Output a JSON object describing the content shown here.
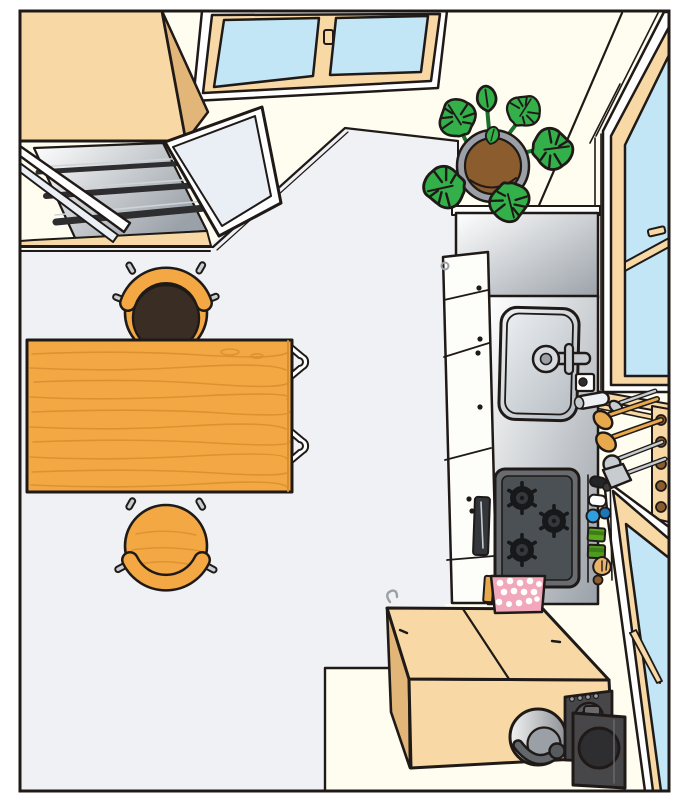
{
  "meta": {
    "title": "Bird's-eye illustration of a small kitchen",
    "image_type": "flat vector illustration",
    "view": "top-down perspective, no text labels"
  },
  "palette": {
    "outline": "#1f1a17",
    "frame_white": "#ffffff",
    "wall": "#fffdf0",
    "floor": "#eff1f4",
    "wood_light": "#f8d9a5",
    "wood_shade": "#e2b579",
    "glass_blue": "#c3e6f7",
    "glass_pale": "#e9eff4",
    "table_wood": "#f3a844",
    "table_grain": "#d88f2e",
    "seat_dark": "#3a2d24",
    "peg_gray": "#c8cdd2",
    "steel_light": "#ffffff",
    "steel_dark": "#9aa1a8",
    "basin_light": "#eef1f3",
    "basin_dark": "#b4bbc2",
    "stove_rim": "#686c70",
    "stove_panel": "#4b5054",
    "burner_black": "#17181a",
    "burner_mid": "#34373b",
    "cloth_pink": "#f2a8bb",
    "cloth_spot": "#ffffff",
    "leaf_green": "#33b04a",
    "stem_green": "#1d6f2d",
    "pot_brown": "#8a5c2e",
    "pot_rim": "#9aa0a6",
    "metal_gray": "#c7ccd0",
    "spoon_wood": "#e8a84c",
    "pot_grad_light": "#f2f2f2",
    "pot_grad_dark": "#8e9296",
    "appliance_dark": "#47474a",
    "appliance_face": "#2e2e31",
    "appliance_lid": "#55595d",
    "bottle_black": "#232427",
    "bottle_white": "#ffffff",
    "bottle_blue": "#2f9fe0",
    "bottle_blue2": "#1878b8",
    "bottle_green": "#5aa822",
    "bottle_green2": "#4c9a1e",
    "garlic_tan": "#e9b469",
    "shelf_dark": "#2e2e30"
  },
  "scene": {
    "objects": [
      {
        "name": "wall-cupboard",
        "desc": "wood cupboard in top-left corner, two glass doors swung open, glass shelves inside"
      },
      {
        "name": "sliding-window-top",
        "desc": "two-pane sliding window on top wall with center latch"
      },
      {
        "name": "window-right-upper",
        "desc": "tall sash window on right wall with latch"
      },
      {
        "name": "window-right-lower",
        "desc": "second window lower on right wall reaching bottom corner"
      },
      {
        "name": "monstera-plant",
        "desc": "potted monstera in the top-right room corner"
      },
      {
        "name": "kitchen-counter",
        "desc": "stainless counter unit with white cabinet doors"
      },
      {
        "name": "sink",
        "desc": "stainless sink with single-lever faucet, soap pump and towel roll"
      },
      {
        "name": "gas-stove",
        "desc": "gas cooktop with three burners and fish-grill slot"
      },
      {
        "name": "condiment-rack",
        "desc": "bottles: black, white, blue, two green boxes, garlic"
      },
      {
        "name": "utensil-wall",
        "desc": "two wooden spoons, metal spoon, ladle and turner hung between windows"
      },
      {
        "name": "dish-towel",
        "desc": "pink spotted towel hanging under the stove"
      },
      {
        "name": "dining-table",
        "desc": "rectangular wooden table with grain"
      },
      {
        "name": "chair-north",
        "desc": "chair with dark round cushion at top side of table"
      },
      {
        "name": "chair-south",
        "desc": "plain wooden chair at bottom side of table"
      },
      {
        "name": "chairs-tucked",
        "desc": "two chair backs tucked under right edge of table"
      },
      {
        "name": "storage-chest",
        "desc": "low wooden chest with split lid near bottom wall"
      },
      {
        "name": "pot",
        "desc": "metal pot with dark handle sitting by the chest"
      },
      {
        "name": "rice-cooker",
        "desc": "dark two-part appliance in bottom-right corner"
      }
    ]
  }
}
